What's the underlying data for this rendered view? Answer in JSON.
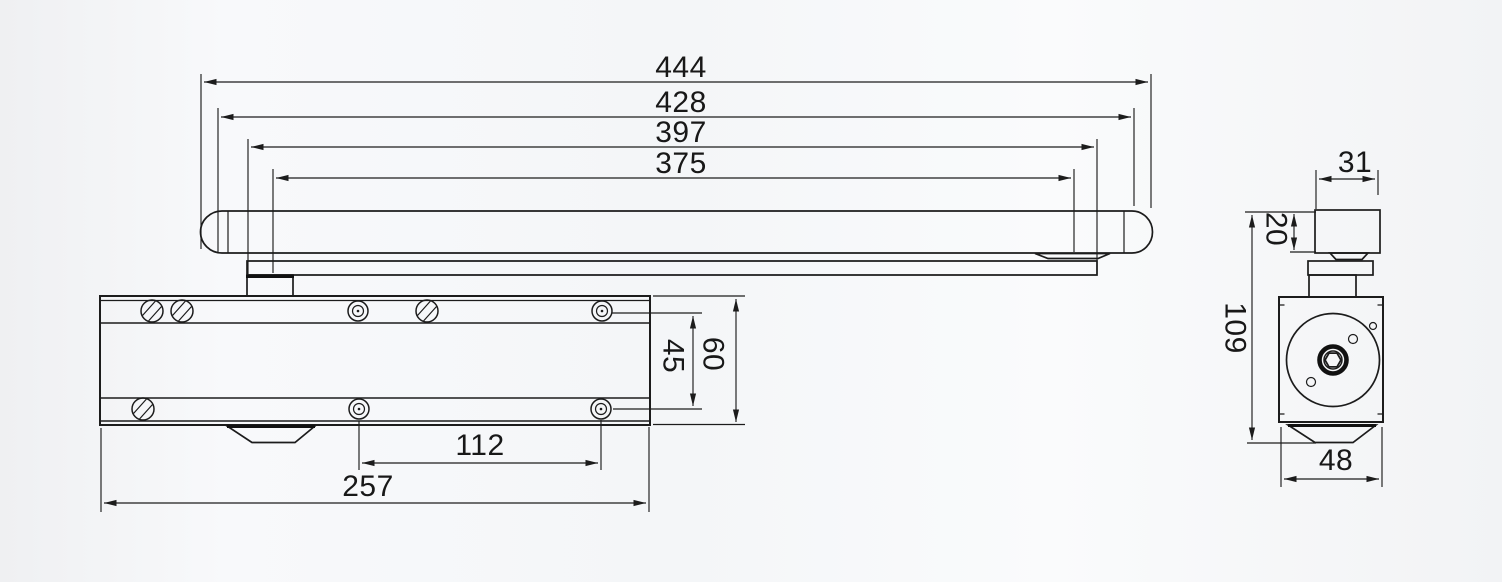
{
  "colors": {
    "line": "#1c1c1c",
    "background": "#f4f5f7"
  },
  "front_view": {
    "top_dimensions": [
      "444",
      "428",
      "397",
      "375"
    ],
    "right_dimensions": [
      "45",
      "60"
    ],
    "bottom_dimensions": [
      "112",
      "257"
    ]
  },
  "side_view": {
    "rail_width": "31",
    "rail_height": "20",
    "overall_height": "109",
    "body_width": "48"
  }
}
